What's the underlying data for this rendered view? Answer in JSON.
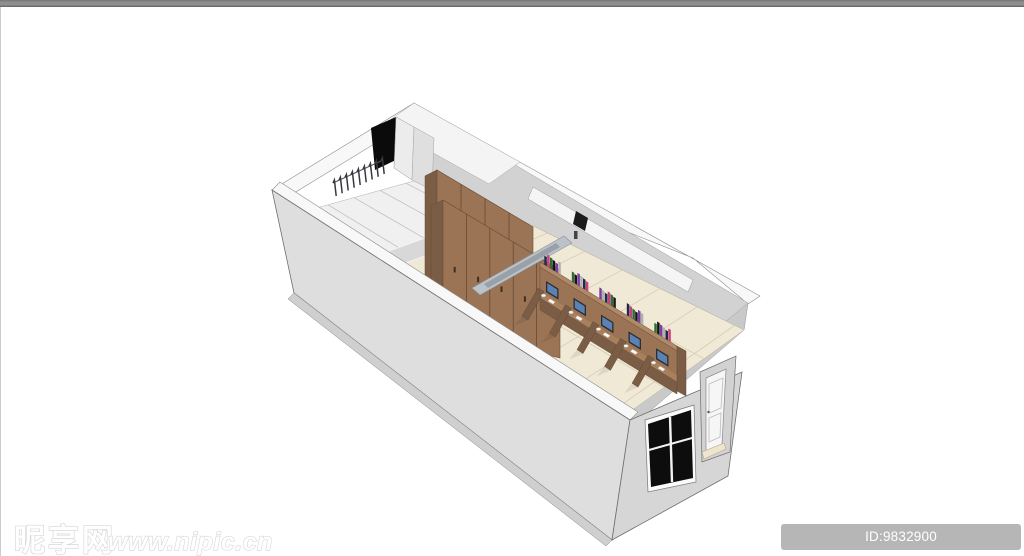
{
  "page": {
    "background": "#ffffff",
    "top_bar_color": "#8c8c8c",
    "left_border_color": "#cccccc"
  },
  "watermark": {
    "logo_text": "昵享网",
    "site_url": "www.nipic.cn",
    "fill": "#ffffff",
    "outline": "#d6d6d6"
  },
  "id_badge": {
    "text": "ID:9832900 NO:20200821172337180088",
    "background": "#b6b6b6",
    "text_color": "#ffffff"
  },
  "scene": {
    "title": "3d-room-interior-model",
    "description": "SketchUp-style bird's-eye cutaway of a long rectangular room: balcony with clothes hanger rack, tall wooden wardrobe cabinets, a suspended light fixture, and a row of five computer study carrels with books; exterior shows a black window and a white door",
    "objects": [
      "balcony-clothes-rack",
      "black-doorway",
      "wardrobe-cabinets",
      "ceiling-light-beam",
      "computer-desk-row",
      "books",
      "monitors",
      "tiled-floor",
      "baseboard-strips",
      "exterior-window",
      "exterior-door"
    ],
    "counts": {
      "desk_stations": 5,
      "books_per_station": 6,
      "hangers": 9,
      "wardrobe1_seams": 3,
      "wardrobe1_handles": 4,
      "wardrobe2_seams": 4,
      "wardrobe2_handles": 5,
      "floor_cross_lines": 6,
      "floor_long_lines": 2,
      "balcony_stripes": 4,
      "baseboard_strips": 3
    },
    "palette": {
      "wall_light": "#dedede",
      "wall_mid": "#d6d6d6",
      "wall_dark": "#c9c9c9",
      "wall_interior": "#d2d2d2",
      "rim_white": "#f8f8f8",
      "roof_white": "#f4f4f4",
      "floor_beige": "#f0e9d6",
      "floor_line": "#d6ccb2",
      "balcony_floor": "#f0f0f0",
      "wood_front": "#9b7355",
      "wood_front2": "#a8805c",
      "wood_side": "#7b5c44",
      "wood_top": "#b08a66",
      "wood_dark_seam": "#5f4632",
      "screen_blue": "#5b82b5",
      "monitor_dark": "#2e2e2e",
      "beam_gray": "#bcc2c9",
      "beam_slot": "#99a1a8",
      "window_black": "#0d0d0d",
      "doorway_black": "#0b0b0b",
      "hanger_dark": "#383840",
      "threshold_beige": "#efe5cf",
      "outline": "#6e6e6e"
    },
    "book_colors": [
      "#1e2a4a",
      "#c9407e",
      "#2f6b35",
      "#151515",
      "#7a3fa0",
      "#b0b0b0"
    ]
  }
}
